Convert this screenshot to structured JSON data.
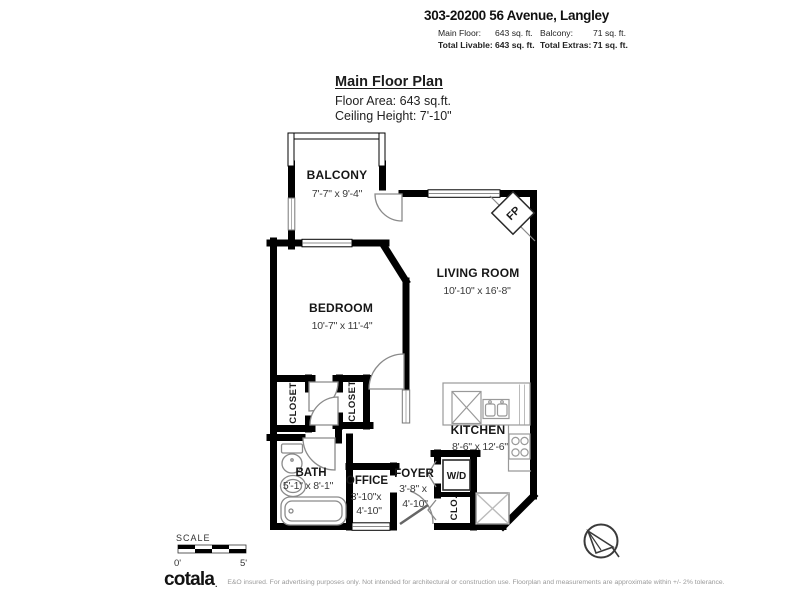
{
  "header": {
    "address": "303-20200 56 Avenue, Langley",
    "stats": {
      "row1": {
        "label1": "Main Floor:",
        "value1": "643 sq. ft.",
        "label2": "Balcony:",
        "value2": "71 sq. ft."
      },
      "row2": {
        "label1": "Total Livable:",
        "value1": "643 sq. ft.",
        "label2": "Total Extras:",
        "value2": "71 sq. ft."
      }
    }
  },
  "plan_header": {
    "title": "Main Floor Plan",
    "floor_area": "Floor Area: 643 sq.ft.",
    "ceiling_height": "Ceiling Height: 7'-10\""
  },
  "rooms": {
    "balcony": {
      "name": "BALCONY",
      "dims": "7'-7\" x 9'-4\""
    },
    "bedroom": {
      "name": "BEDROOM",
      "dims": "10'-7\" x 11'-4\""
    },
    "living_room": {
      "name": "LIVING ROOM",
      "dims": "10'-10\" x 16'-8\""
    },
    "kitchen": {
      "name": "KITCHEN",
      "dims": "8'-6\" x 12'-6\""
    },
    "bath": {
      "name": "BATH",
      "dims": "5'-1\" x 8'-1\""
    },
    "office": {
      "name": "OFFICE",
      "dims_line1": "3'-10\"x",
      "dims_line2": "4'-10\""
    },
    "foyer": {
      "name": "FOYER",
      "dims_line1": "3'-8\" x",
      "dims_line2": "4'-10\""
    }
  },
  "fixtures": {
    "fireplace": "FP",
    "washer_dryer": "W/D",
    "closet_small": "CLO.",
    "closet_left": "CLOSET",
    "closet_right": "CLOSET"
  },
  "scale_bar": {
    "label": "SCALE",
    "min": "0'",
    "max": "5'"
  },
  "footer": {
    "brand": "cotala",
    "brand_mark": ".",
    "disclaimer": "E&O insured. For advertising purposes only. Not intended for architectural or construction use. Floorplan and measurements are approximate within +/- 2% tolerance."
  },
  "colors": {
    "wall": "#000000",
    "fixture_line": "#8a8a8a",
    "text_primary": "#161616",
    "text_secondary": "#3a3a3a",
    "disclaimer": "#9a9a9a"
  }
}
